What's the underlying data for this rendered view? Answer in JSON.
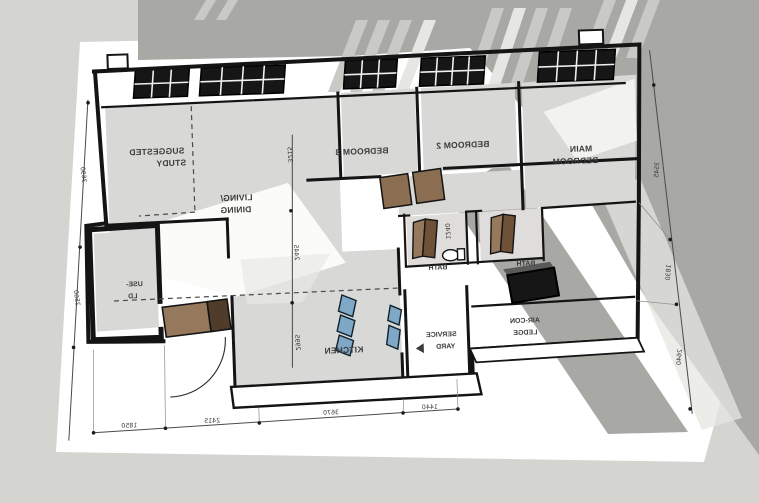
{
  "labels": {
    "suggested_study": [
      "SUGGESTED",
      "STUDY"
    ],
    "living_dining": [
      "LIVING/",
      "DINING"
    ],
    "bedroom3": "BEDROOM 3",
    "bedroom2": "BEDROOM 2",
    "main_bedroom": [
      "MAIN",
      "BEDROOM"
    ],
    "kitchen": "KITCHEN",
    "service_yard": [
      "SERVICE",
      "YARD"
    ],
    "aircon_ledge": [
      "AIR-CON",
      "LEDGE"
    ],
    "bath_left": "BATH",
    "bath_right": "BATH",
    "household_shelter": [
      "USE-",
      "LD"
    ]
  },
  "dimensions": {
    "bottom": [
      "1850",
      "2415",
      "3670",
      "1440"
    ],
    "left": [
      "3690",
      "2560"
    ],
    "right": [
      "3545",
      "1830",
      "2640"
    ],
    "interior": [
      "3215",
      "2445",
      "2995"
    ],
    "bath": "1240"
  },
  "colors": {
    "background": "#d4d4d0",
    "watermark": "#a8a8a4",
    "stripe_light": "#c9c9c5",
    "stripe_white": "#e6e6e2",
    "paper": "#ffffff",
    "floor": "#d8d8d6",
    "line": "#141414",
    "door_light": "#96785c",
    "door_mid": "#8b6d52",
    "door_dark": "#503c2a",
    "glass_blue": "#7fa8c6",
    "unit_black": "#161616"
  }
}
